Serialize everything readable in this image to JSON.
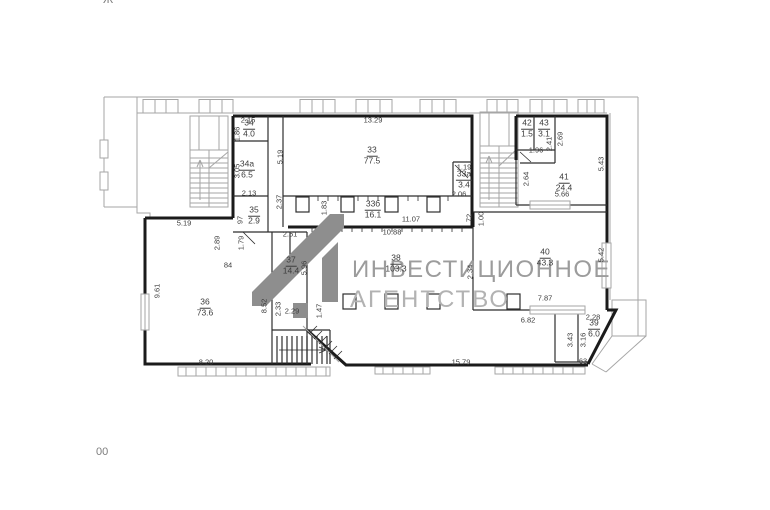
{
  "canvas": {
    "background": "#ffffff"
  },
  "fragments": {
    "top_left": "Ж",
    "bottom_left": "00"
  },
  "watermark": {
    "line1": "ИНВЕСТИЦИОННОЕ",
    "line2": "АГЕНТСТВО",
    "text_color": "#9c9c9c",
    "text_color2": "#b2b2b2",
    "logo_color": "#8e8e8e",
    "logo_icon": "investment-agency-monogram"
  },
  "plan": {
    "context_color": "#a6a6a6",
    "wall_color": "#1b1b1b",
    "label_color": "#3c3c3c",
    "rooms": [
      {
        "number": "34",
        "area": "4.0",
        "x": 249,
        "y": 129
      },
      {
        "number": "34а",
        "area": "6.5",
        "x": 247,
        "y": 170
      },
      {
        "number": "35",
        "area": "2.9",
        "x": 254,
        "y": 216
      },
      {
        "number": "33",
        "area": "77.5",
        "x": 372,
        "y": 156
      },
      {
        "number": "33а",
        "area": "3.4",
        "x": 464,
        "y": 180
      },
      {
        "number": "33б",
        "area": "16.1",
        "x": 373,
        "y": 210
      },
      {
        "number": "36",
        "area": "73.6",
        "x": 205,
        "y": 308
      },
      {
        "number": "37",
        "area": "14.4",
        "x": 291,
        "y": 266
      },
      {
        "number": "38",
        "area": "103.3",
        "x": 396,
        "y": 264
      },
      {
        "number": "39",
        "area": "6.0",
        "x": 594,
        "y": 329
      },
      {
        "number": "40",
        "area": "43.3",
        "x": 545,
        "y": 258
      },
      {
        "number": "41",
        "area": "24.4",
        "x": 564,
        "y": 183
      },
      {
        "number": "42",
        "area": "1.5",
        "x": 527,
        "y": 129
      },
      {
        "number": "43",
        "area": "3.1",
        "x": 544,
        "y": 129
      }
    ],
    "dims": [
      {
        "text": "2.15",
        "x": 248,
        "y": 120
      },
      {
        "text": "1.86",
        "x": 237,
        "y": 134,
        "rot": 1
      },
      {
        "text": "3.05",
        "x": 237,
        "y": 171,
        "rot": 1
      },
      {
        "text": "2.13",
        "x": 249,
        "y": 193
      },
      {
        "text": "5.19",
        "x": 280,
        "y": 157,
        "rot": 1
      },
      {
        "text": "13.29",
        "x": 373,
        "y": 120
      },
      {
        "text": "1.19",
        "x": 464,
        "y": 167
      },
      {
        "text": "2.06",
        "x": 459,
        "y": 194
      },
      {
        "text": "1.96",
        "x": 536,
        "y": 150
      },
      {
        "text": "2.41",
        "x": 549,
        "y": 144,
        "rot": 1
      },
      {
        "text": "2.69",
        "x": 560,
        "y": 139,
        "rot": 1
      },
      {
        "text": "2.64",
        "x": 526,
        "y": 179,
        "rot": 1
      },
      {
        "text": "5.43",
        "x": 601,
        "y": 164,
        "rot": 1
      },
      {
        "text": "5.66",
        "x": 562,
        "y": 194
      },
      {
        "text": "5.19",
        "x": 184,
        "y": 223
      },
      {
        "text": "2.89",
        "x": 217,
        "y": 243,
        "rot": 1
      },
      {
        "text": "1.79",
        "x": 241,
        "y": 243,
        "rot": 1
      },
      {
        "text": "97",
        "x": 240,
        "y": 220,
        "rot": 1
      },
      {
        "text": "2.37",
        "x": 279,
        "y": 202,
        "rot": 1
      },
      {
        "text": "84",
        "x": 228,
        "y": 265
      },
      {
        "text": "9.61",
        "x": 157,
        "y": 291,
        "rot": 1
      },
      {
        "text": "2.51",
        "x": 290,
        "y": 234
      },
      {
        "text": "5.96",
        "x": 304,
        "y": 268,
        "rot": 1
      },
      {
        "text": "1.83",
        "x": 324,
        "y": 208,
        "rot": 1
      },
      {
        "text": "2.33",
        "x": 278,
        "y": 309,
        "rot": 1
      },
      {
        "text": "8.52",
        "x": 264,
        "y": 306,
        "rot": 1
      },
      {
        "text": "2.29",
        "x": 292,
        "y": 311
      },
      {
        "text": "1.47",
        "x": 319,
        "y": 311,
        "rot": 1
      },
      {
        "text": "11.07",
        "x": 411,
        "y": 219
      },
      {
        "text": "10.88",
        "x": 392,
        "y": 232
      },
      {
        "text": "72",
        "x": 469,
        "y": 218,
        "rot": 1
      },
      {
        "text": "1.00",
        "x": 481,
        "y": 219,
        "rot": 1
      },
      {
        "text": "2.34",
        "x": 470,
        "y": 272,
        "rot": 1
      },
      {
        "text": "5.42",
        "x": 601,
        "y": 255,
        "rot": 1
      },
      {
        "text": "7.87",
        "x": 545,
        "y": 298
      },
      {
        "text": "6.82",
        "x": 528,
        "y": 320
      },
      {
        "text": "2.28",
        "x": 593,
        "y": 317
      },
      {
        "text": "3.43",
        "x": 570,
        "y": 340,
        "rot": 1
      },
      {
        "text": "3.16",
        "x": 583,
        "y": 340,
        "rot": 1
      },
      {
        "text": "63",
        "x": 583,
        "y": 361
      },
      {
        "text": "15.79",
        "x": 461,
        "y": 362
      },
      {
        "text": "8.20",
        "x": 206,
        "y": 362
      }
    ]
  }
}
